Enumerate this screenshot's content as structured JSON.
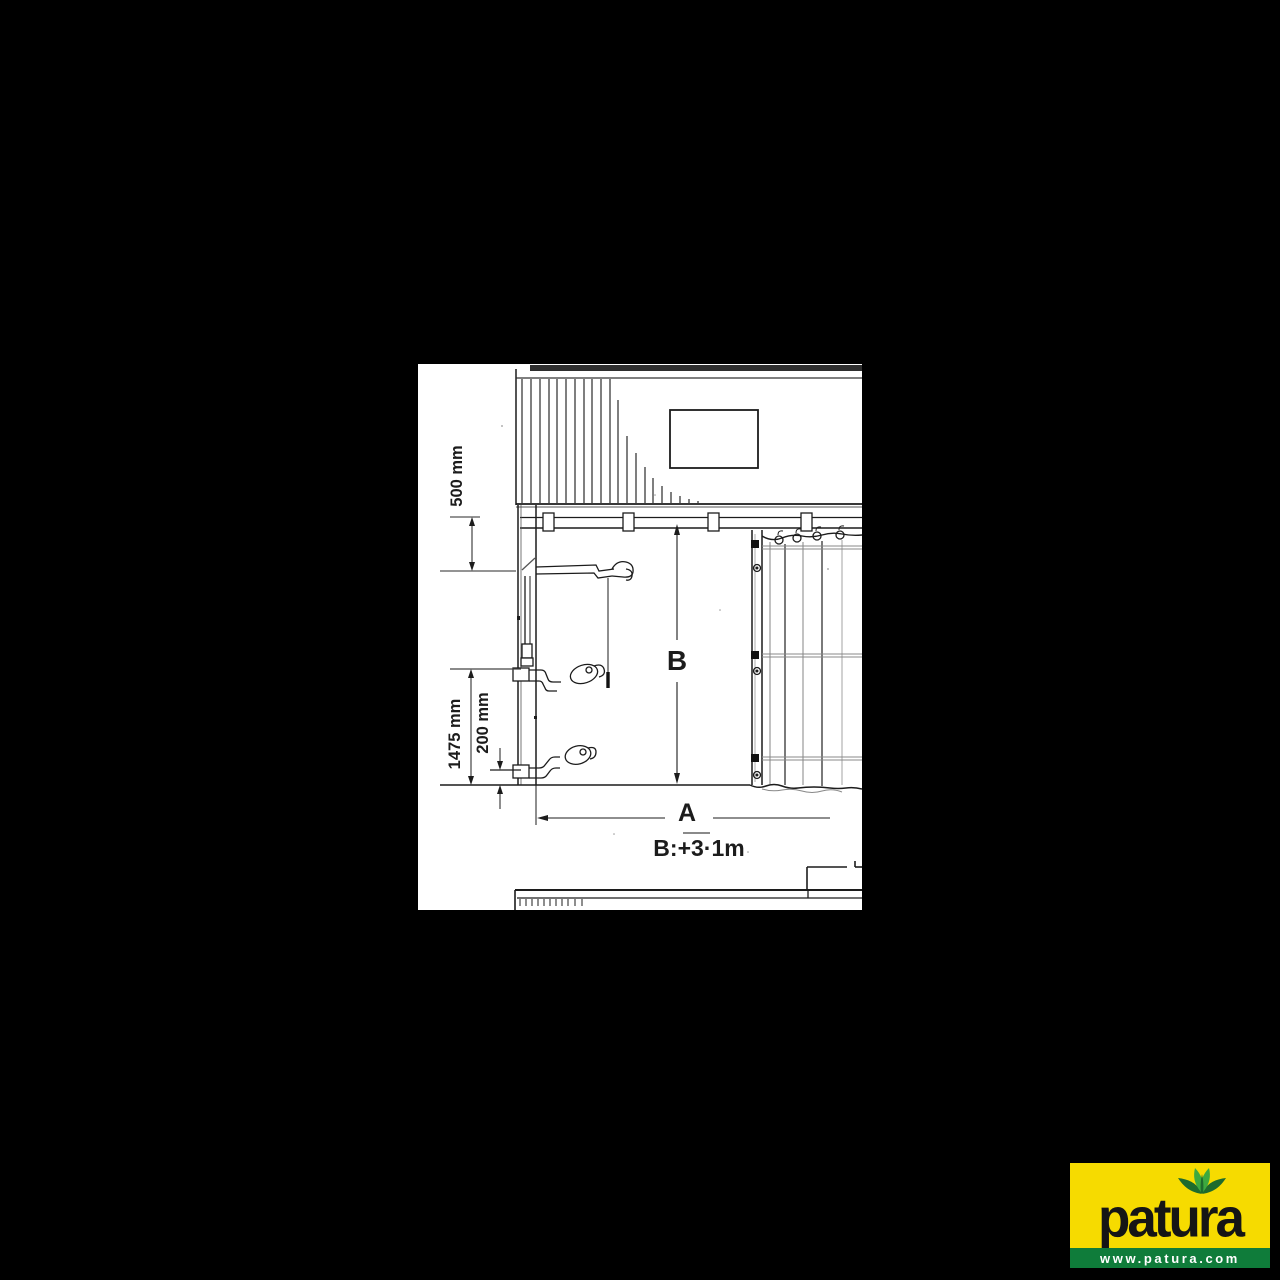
{
  "diagram": {
    "description": "Technical installation drawing of a windbreak curtain system on a barn wall with winch cranks, dimension callouts and a hanging curtain panel",
    "labels": {
      "dim_500": "500 mm",
      "dim_1475": "1475 mm",
      "dim_200": "200 mm",
      "dim_B": "B",
      "dim_A": "A",
      "formula": "B:+3·1m"
    },
    "colors": {
      "paper": "#ffffff",
      "ink": "#1c1c1c",
      "faint": "#888888",
      "background": "#000000"
    }
  },
  "logo": {
    "brand": "patura",
    "website": "www.patura.com",
    "leaf_icon": "plant-leaves",
    "colors": {
      "yellow": "#F6DB00",
      "green_bar": "#0F7C3A",
      "leaf_dark": "#1E6B2D",
      "leaf_light": "#3DA93F",
      "wordmark": "#151515",
      "site_text": "#ffffff"
    }
  }
}
